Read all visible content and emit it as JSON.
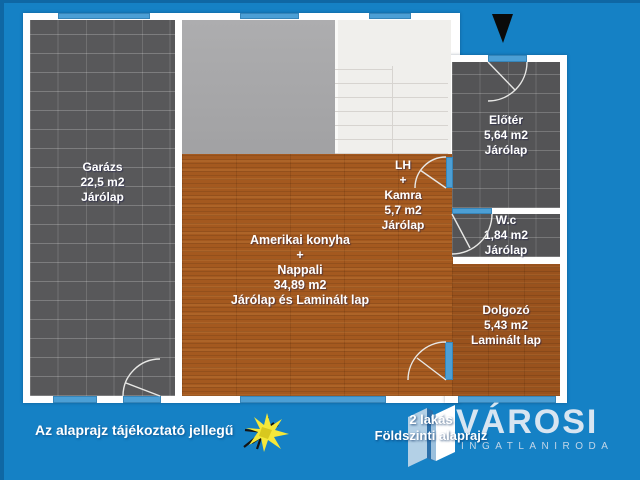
{
  "colors": {
    "background": "#1581c5",
    "wall": "#ffffff",
    "window_door": "#4c9fd5",
    "tile_floor": "#58585a",
    "concrete": "#a8a8aa",
    "stairs": "#f0efec",
    "wood_living": "#a4591f",
    "wood_office": "#99521d",
    "north_arrow": "#0a0a0a",
    "logo_text": "#d8e5f1"
  },
  "icons": {
    "north_arrow": "north-arrow-icon",
    "sun": "sun-burst-icon",
    "logo_building": "building-icon"
  },
  "rooms": [
    {
      "id": "garage",
      "lines": [
        "Garázs",
        "22,5 m2",
        "Járólap"
      ]
    },
    {
      "id": "living",
      "lines": [
        "Amerikai konyha",
        "+",
        "Nappali",
        "34,89 m2",
        "Járólap és Laminált lap"
      ]
    },
    {
      "id": "lh",
      "lines": [
        "LH",
        "+",
        "Kamra",
        "5,7 m2",
        "Járólap"
      ]
    },
    {
      "id": "eloter",
      "lines": [
        "Előtér",
        "5,64 m2",
        "Járólap"
      ]
    },
    {
      "id": "wc",
      "lines": [
        "W.c",
        "1,84 m2",
        "Járólap"
      ]
    },
    {
      "id": "dolgozo",
      "lines": [
        "Dolgozó",
        "5,43 m2",
        "Laminált lap"
      ]
    }
  ],
  "footer": {
    "disclaimer": "Az alaprajz tájékoztató jellegű",
    "unit_line1": "2 lakás",
    "unit_line2": "Földszinti alaprajz"
  },
  "logo": {
    "name": "VÁROSI",
    "subtitle": "INGATLANIRODA"
  }
}
